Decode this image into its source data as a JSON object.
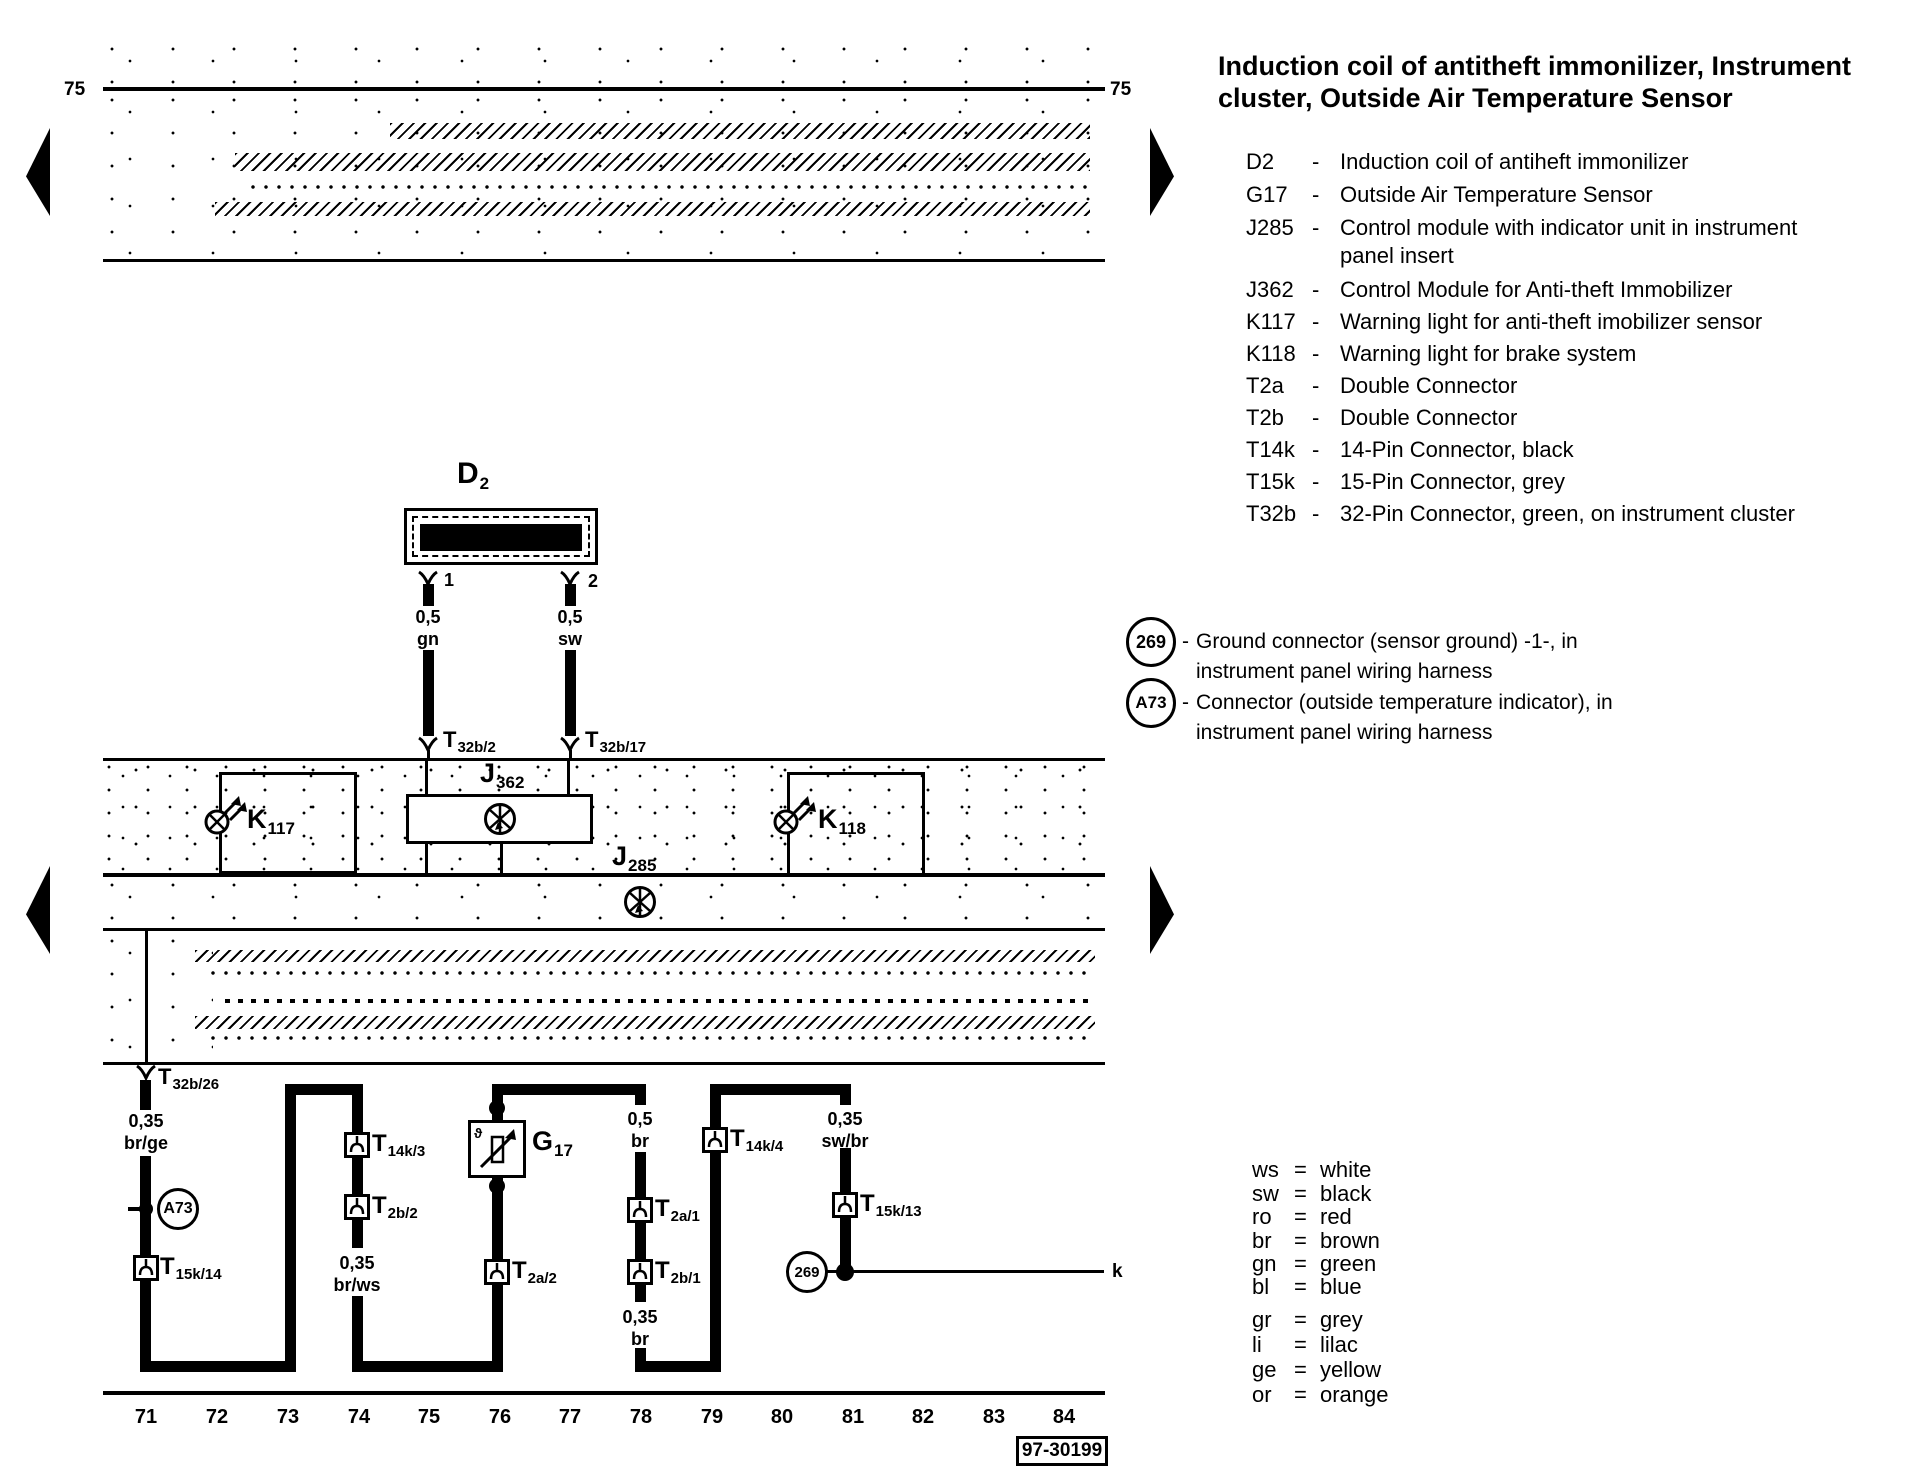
{
  "dash": "-",
  "eq": "=",
  "title": {
    "line1": "Induction coil of antitheft immonilizer, Instrument",
    "line2": "cluster, Outside Air Temperature Sensor"
  },
  "legend": {
    "items": [
      {
        "code": "D2",
        "desc": "Induction coil of antiheft immonilizer",
        "desc2": ""
      },
      {
        "code": "G17",
        "desc": "Outside Air Temperature Sensor",
        "desc2": ""
      },
      {
        "code": "J285",
        "desc": "Control module with indicator unit in instrument",
        "desc2": "panel insert"
      },
      {
        "code": "J362",
        "desc": "Control Module for Anti-theft Immobilizer",
        "desc2": ""
      },
      {
        "code": "K117",
        "desc": "Warning light for anti-theft imobilizer sensor",
        "desc2": ""
      },
      {
        "code": "K118",
        "desc": "Warning light for brake system",
        "desc2": ""
      },
      {
        "code": "T2a",
        "desc": "Double Connector",
        "desc2": ""
      },
      {
        "code": "T2b",
        "desc": "Double Connector",
        "desc2": ""
      },
      {
        "code": "T14k",
        "desc": "14-Pin Connector, black",
        "desc2": ""
      },
      {
        "code": "T15k",
        "desc": "15-Pin Connector, grey",
        "desc2": ""
      },
      {
        "code": "T32b",
        "desc": "32-Pin Connector, green, on instrument cluster",
        "desc2": ""
      }
    ]
  },
  "notes": [
    {
      "label": "269",
      "line1": "Ground connector (sensor ground) -1-, in",
      "line2": "instrument panel wiring harness"
    },
    {
      "label": "A73",
      "line1": "Connector (outside temperature indicator), in",
      "line2": "instrument panel wiring harness"
    }
  ],
  "wirecolors": {
    "items": [
      {
        "abbr": "ws",
        "name": "white"
      },
      {
        "abbr": "sw",
        "name": "black"
      },
      {
        "abbr": "ro",
        "name": "red"
      },
      {
        "abbr": "br",
        "name": "brown"
      },
      {
        "abbr": "gn",
        "name": "green"
      },
      {
        "abbr": "bl",
        "name": "blue"
      },
      {
        "abbr": "gr",
        "name": "grey"
      },
      {
        "abbr": "li",
        "name": "lilac"
      },
      {
        "abbr": "ge",
        "name": "yellow"
      },
      {
        "abbr": "or",
        "name": "orange"
      }
    ]
  },
  "tracks": [
    "71",
    "72",
    "73",
    "74",
    "75",
    "76",
    "77",
    "78",
    "79",
    "80",
    "81",
    "82",
    "83",
    "84"
  ],
  "diagram": {
    "rail75_left": "75",
    "rail75_right": "75",
    "d2": {
      "main": "D",
      "sub": "2"
    },
    "pin1": "1",
    "pin2": "2",
    "w_d2_1": {
      "size": "0,5",
      "color": "gn"
    },
    "w_d2_2": {
      "size": "0,5",
      "color": "sw"
    },
    "t32b2": {
      "main": "T",
      "sub": "32b/2"
    },
    "t32b17": {
      "main": "T",
      "sub": "32b/17"
    },
    "j362": {
      "main": "J",
      "sub": "362"
    },
    "j285": {
      "main": "J",
      "sub": "285"
    },
    "k117": {
      "main": "K",
      "sub": "117"
    },
    "k118": {
      "main": "K",
      "sub": "118"
    },
    "t32b26": {
      "main": "T",
      "sub": "32b/26"
    },
    "w_brge": {
      "size": "0,35",
      "color": "br/ge"
    },
    "a73": "A73",
    "t15k14": {
      "main": "T",
      "sub": "15k/14"
    },
    "t14k3": {
      "main": "T",
      "sub": "14k/3"
    },
    "t2b2": {
      "main": "T",
      "sub": "2b/2"
    },
    "w_brws": {
      "size": "0,35",
      "color": "br/ws"
    },
    "g17": {
      "main": "G",
      "sub": "17"
    },
    "t2a2": {
      "main": "T",
      "sub": "2a/2"
    },
    "w_br05": {
      "size": "0,5",
      "color": "br"
    },
    "t2a1": {
      "main": "T",
      "sub": "2a/1"
    },
    "t2b1": {
      "main": "T",
      "sub": "2b/1"
    },
    "w_br035": {
      "size": "0,35",
      "color": "br"
    },
    "t14k4": {
      "main": "T",
      "sub": "14k/4"
    },
    "w_swbr": {
      "size": "0,35",
      "color": "sw/br"
    },
    "t15k13": {
      "main": "T",
      "sub": "15k/13"
    },
    "g269": "269",
    "k": "k",
    "doc": "97-30199"
  }
}
